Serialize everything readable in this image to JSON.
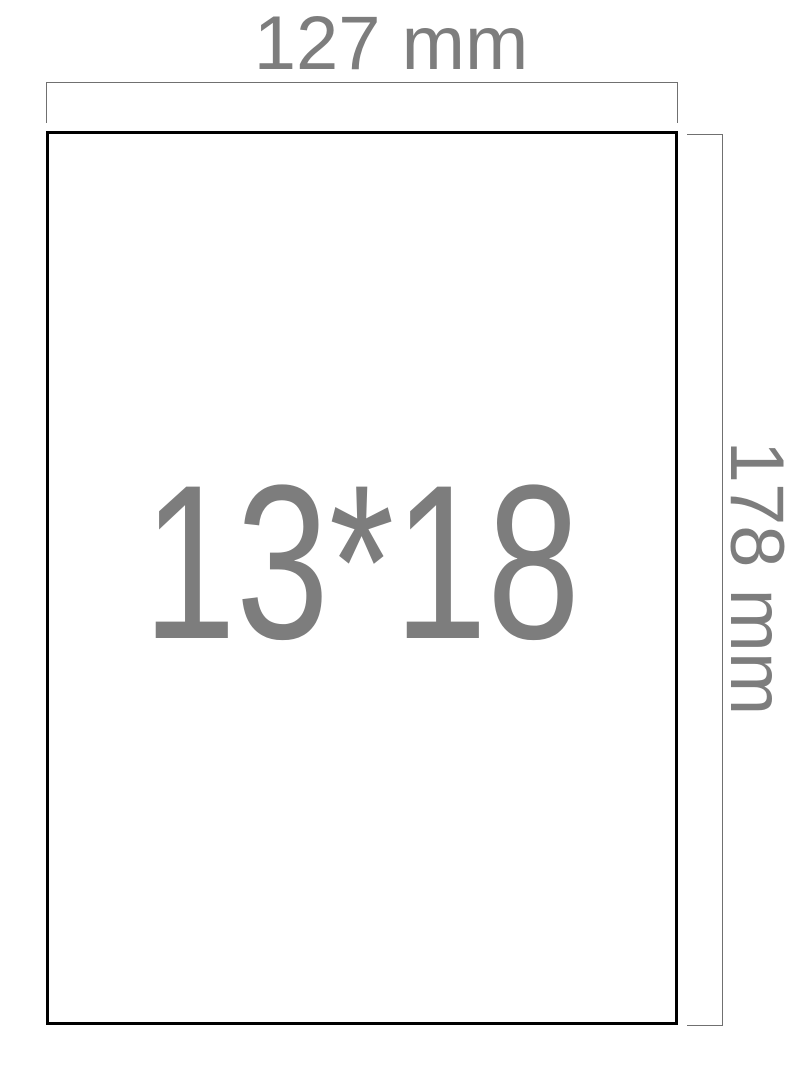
{
  "figure": {
    "type": "paper-size-dimension-diagram",
    "paper_label": "13*18",
    "width_label": "127 mm",
    "height_label": "178 mm"
  },
  "colors": {
    "background": "#ffffff",
    "paper_border": "#000000",
    "dimension_line": "#707070",
    "label_text": "#7d7d7d"
  }
}
